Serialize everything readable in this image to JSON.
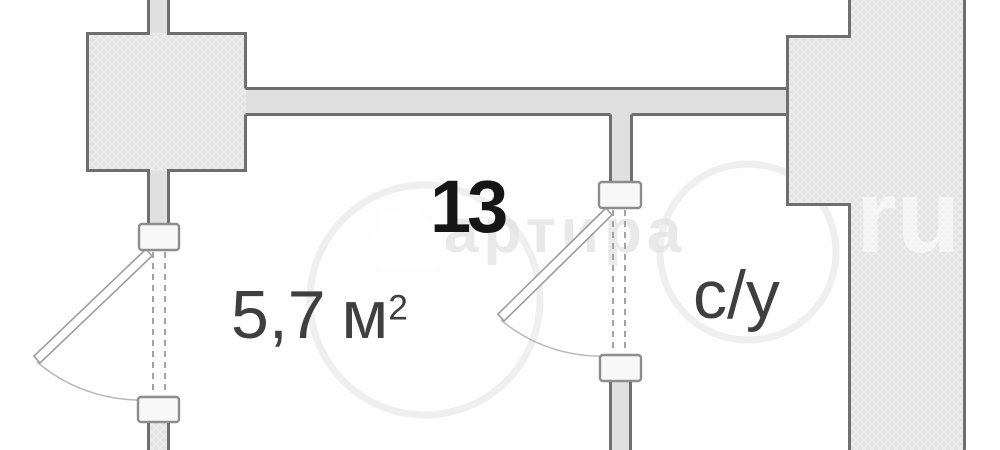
{
  "plan": {
    "room_number": "13",
    "room_area_value": "5,7",
    "room_area_unit": "м",
    "room_area_sup": "2",
    "bathroom_label": "с/у"
  },
  "watermark": {
    "site_text": "артира",
    "site_suffix": "ru",
    "house_icon": "house-icon"
  },
  "colors": {
    "wall_border": "#6f6f6f",
    "wall_fill": "#e3e3e3",
    "wall_fill_plain": "#e0e0e0",
    "label": "#3f3f3f",
    "room_number": "#161616"
  }
}
